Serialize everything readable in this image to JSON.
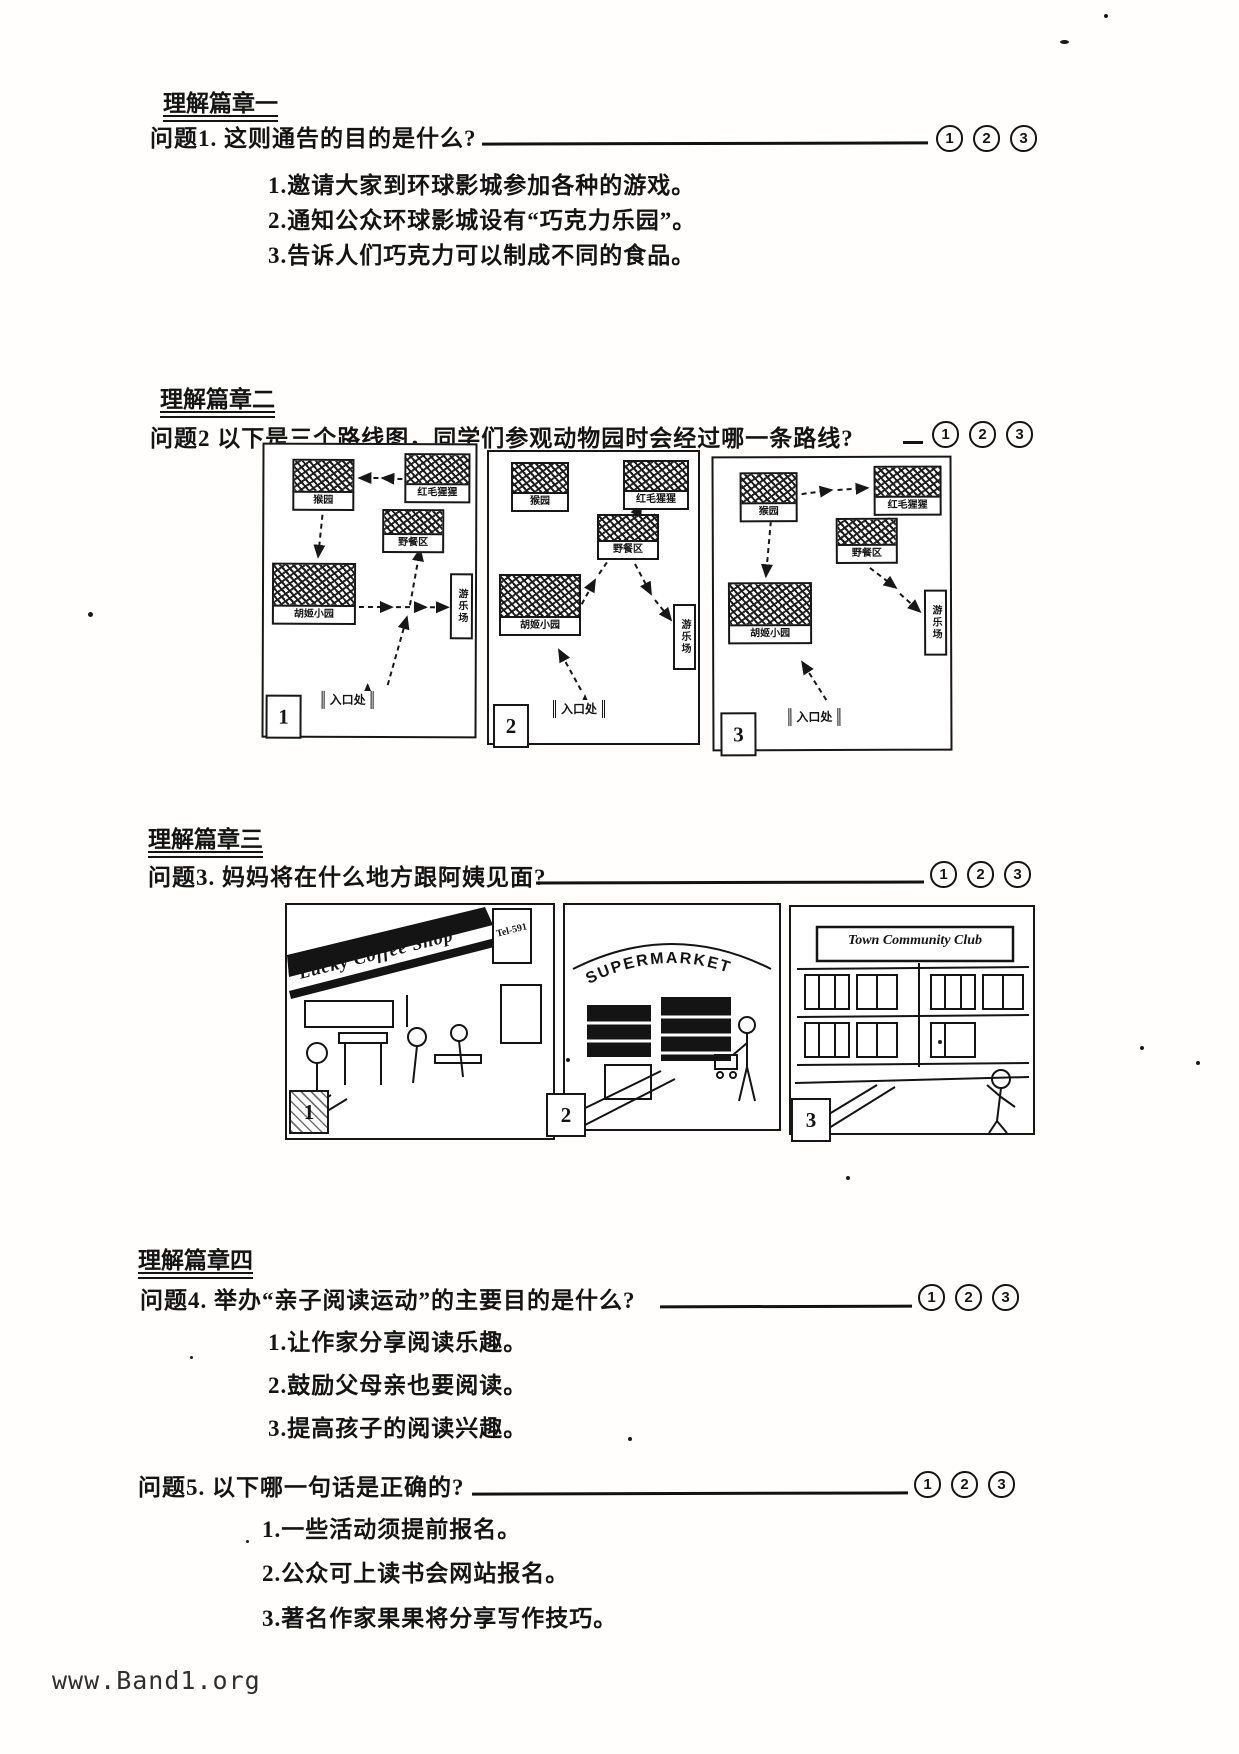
{
  "page": {
    "footer": "www.Band1.org"
  },
  "choices": [
    "1",
    "2",
    "3"
  ],
  "sections": {
    "s1": {
      "heading": "理解篇章一",
      "q1": {
        "text": "问题1. 这则通告的目的是什么?",
        "options": [
          "1.邀请大家到环球影城参加各种的游戏。",
          "2.通知公众环球影城设有“巧克力乐园”。",
          "3.告诉人们巧克力可以制成不同的食品。"
        ]
      }
    },
    "s2": {
      "heading": "理解篇章二",
      "q2": {
        "text": "问题2 以下是三个路线图，同学们参观动物园时会经过哪一条路线?"
      },
      "maps": [
        {
          "number": "1",
          "entrance": "入口处",
          "nodes": {
            "a": "猴园",
            "b": "红毛猩猩",
            "c": "野餐区",
            "d": "胡姬小园",
            "e": "游乐场"
          }
        },
        {
          "number": "2",
          "entrance": "入口处",
          "nodes": {
            "a": "猴园",
            "b": "红毛猩猩",
            "c": "野餐区",
            "d": "胡姬小园",
            "e": "游乐场"
          }
        },
        {
          "number": "3",
          "entrance": "入口处",
          "nodes": {
            "a": "猴园",
            "b": "红毛猩猩",
            "c": "野餐区",
            "d": "胡姬小园",
            "e": "游乐场"
          }
        }
      ]
    },
    "s3": {
      "heading": "理解篇章三",
      "q3": {
        "text": "问题3. 妈妈将在什么地方跟阿姨见面?"
      },
      "scenes": [
        {
          "number": "1",
          "sign": "Lucky Coffee Shop",
          "sign_extra": "Tel-591"
        },
        {
          "number": "2",
          "sign": "SUPERMARKET"
        },
        {
          "number": "3",
          "sign": "Town Community Club"
        }
      ]
    },
    "s4": {
      "heading": "理解篇章四",
      "q4": {
        "text": "问题4. 举办“亲子阅读运动”的主要目的是什么?",
        "options": [
          "1.让作家分享阅读乐趣。",
          "2.鼓励父母亲也要阅读。",
          "3.提高孩子的阅读兴趣。"
        ]
      },
      "q5": {
        "text": "问题5. 以下哪一句话是正确的?",
        "options": [
          "1.一些活动须提前报名。",
          "2.公众可上读书会网站报名。",
          "3.著名作家果果将分享写作技巧。"
        ]
      }
    }
  }
}
